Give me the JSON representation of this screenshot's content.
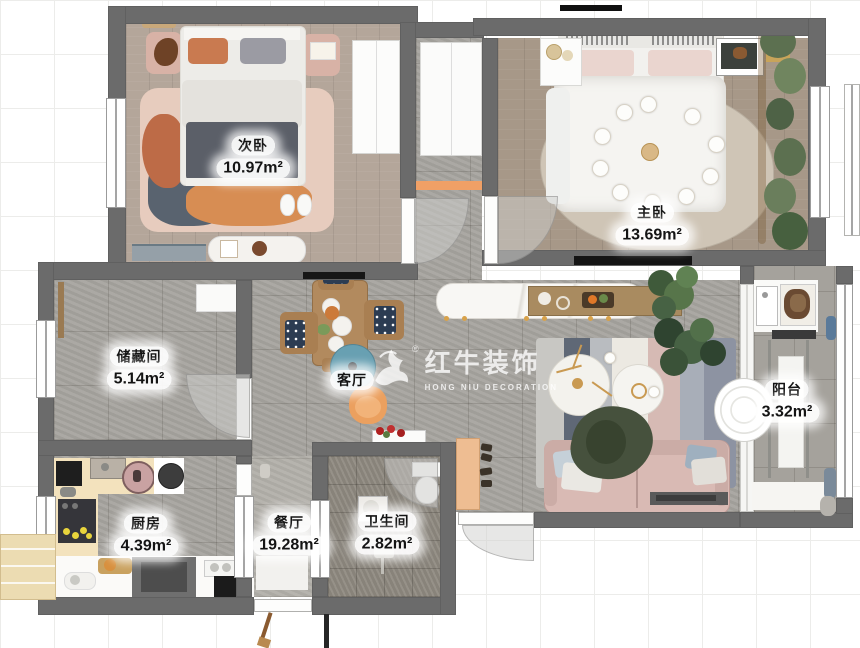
{
  "watermark": {
    "brand": "红牛装饰",
    "subtitle": "HONG NIU DECORATION",
    "registered": "®"
  },
  "rooms": [
    {
      "name": "次卧",
      "area": "10.97m²"
    },
    {
      "name": "主卧",
      "area": "13.69m²"
    },
    {
      "name": "储藏间",
      "area": "5.14m²"
    },
    {
      "name": "客厅",
      "area": ""
    },
    {
      "name": "阳台",
      "area": "3.32m²"
    },
    {
      "name": "厨房",
      "area": "4.39m²"
    },
    {
      "name": "餐厅",
      "area": "19.28m²"
    },
    {
      "name": "卫生间",
      "area": "2.82m²"
    }
  ],
  "colors": {
    "wall": "#6b6b6b",
    "tile_floor": "#a7a49f",
    "wood_floor_secondary": "#b4a69a",
    "wood_floor_master": "#a79888",
    "bath_floor": "#8f8a81",
    "accent_orange": "#f0a066",
    "sofa_pink": "#d9bab4",
    "rug_pink": "#e7ccbe",
    "rug_blue": "#68a0b2",
    "label_text": "#141414"
  }
}
